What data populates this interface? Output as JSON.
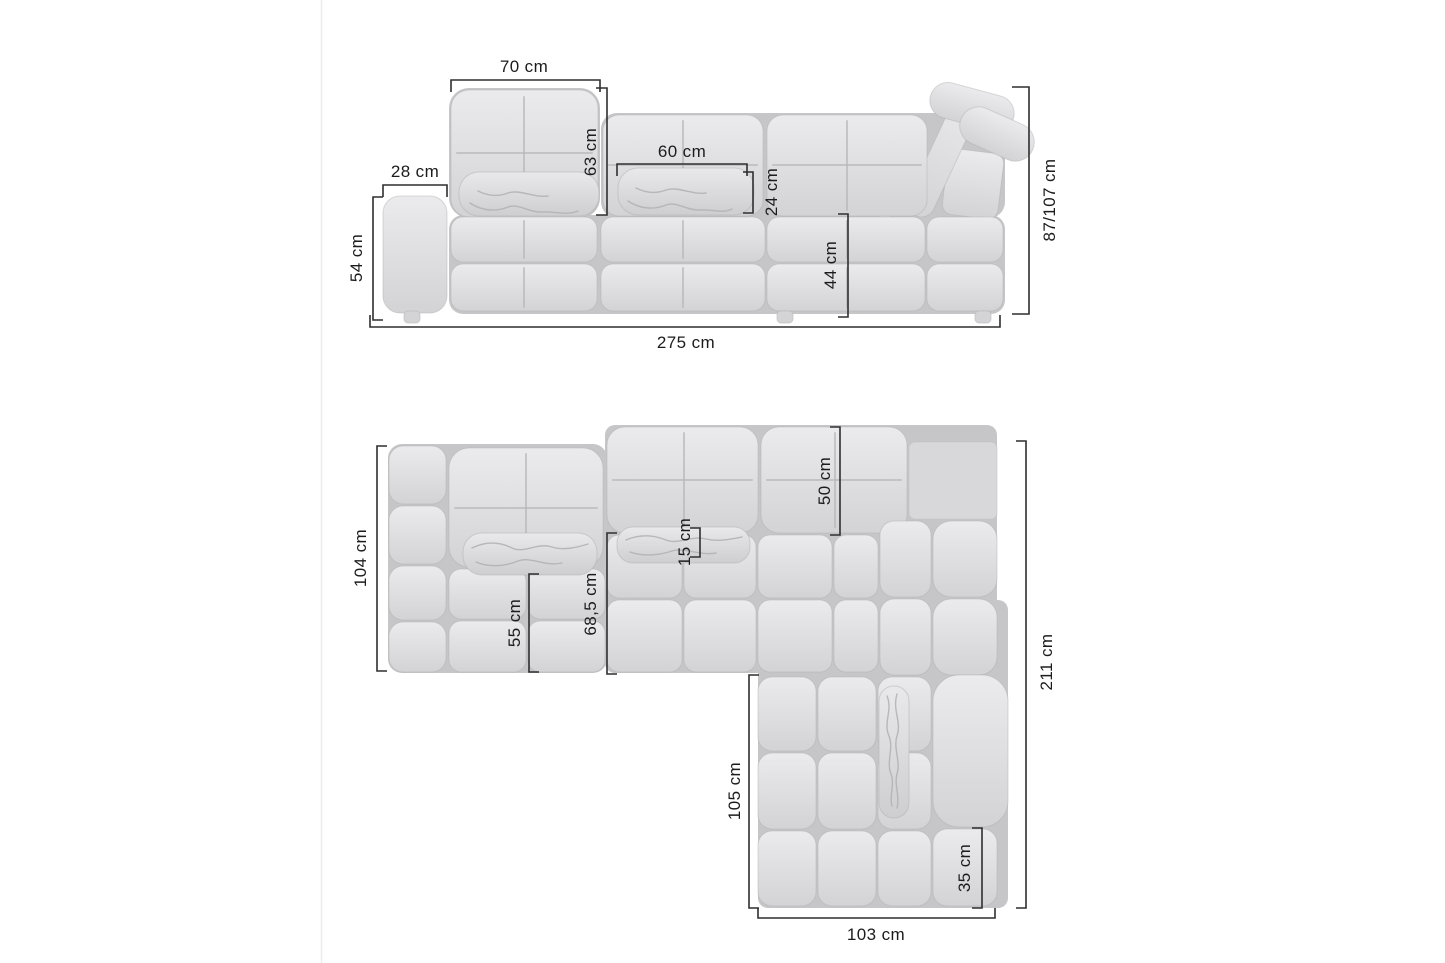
{
  "page": {
    "background": "#ffffff",
    "left_edge_divider_color": "#ececec"
  },
  "colors": {
    "cushion_light": "#ebebed",
    "cushion_dark": "#d3d3d5",
    "crevice": "#c6c6c8",
    "seam": "#b7b7b9",
    "dimension_line": "#2f2f2f",
    "label_text": "#1c1c1c"
  },
  "front_view": {
    "dimensions": {
      "backrest_width": "70 cm",
      "armrest_width": "28 cm",
      "backrest_height": "63 cm",
      "pillow_width": "60 cm",
      "pillow_height": "24 cm",
      "armrest_height": "54 cm",
      "seat_height": "44 cm",
      "total_height": "87/107 cm",
      "total_width": "275 cm"
    }
  },
  "top_view": {
    "dimensions": {
      "left_side_depth": "104 cm",
      "backrest_depth": "50 cm",
      "pillow_depth": "15 cm",
      "seat_depth": "55 cm",
      "seat_depth_total": "68,5 cm",
      "chaise_length": "105 cm",
      "total_depth": "211 cm",
      "corner_armrest_width": "35 cm",
      "chaise_width": "103 cm"
    }
  }
}
